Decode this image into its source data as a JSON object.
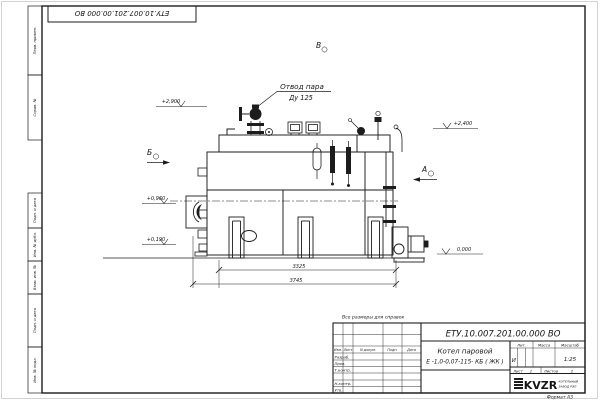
{
  "corner_stamp": {
    "doc_number": "ЕТУ.10.007.201.00.000  ВО"
  },
  "margin_labels": {
    "perv_primen": "Перв. примен.",
    "sprav_no": "Справ. №",
    "podp_data_1": "Подп. и дата",
    "inv_dubl": "Инв. № дубл.",
    "vzam_inv": "Взам. инв. №",
    "podp_data_2": "Подп. и дата",
    "inv_podl": "Инв. № подл."
  },
  "drawing": {
    "callout": {
      "line1": "Отвод пара",
      "line2": "Ду 125"
    },
    "views": {
      "top": "В",
      "left": "Б",
      "right": "А"
    },
    "elevations": {
      "e1": "+2,900",
      "e2": "+2,400",
      "e3": "+0,960",
      "e4": "+0,190",
      "e5": "0,000"
    },
    "dimensions": {
      "d1": "3325",
      "d2": "3745"
    }
  },
  "title_block": {
    "note": "Все размеры для справок",
    "doc_number": "ЕТУ.10.007.201.00.000  ВО",
    "product_name_line1": "Котел паровой",
    "product_name_line2": "Е -1,0-0,07-115- КБ ( ЖК )",
    "header_izm": "Изм.",
    "header_list": "Лист",
    "header_ndoc": "N докум.",
    "header_podp": "Подп.",
    "header_data": "Дата",
    "row_razrab": "Разраб.",
    "row_prov": "Пров.",
    "row_tkontr": "Т.контр.",
    "row_nkontr": "Н.контр.",
    "row_utv": "Утв.",
    "lit_header": "Лит.",
    "massa_header": "Масса",
    "masshtab_header": "Масштаб",
    "lit_value": "И",
    "scale_value": "1:25",
    "sheet_label": "Лист",
    "sheet_value": "1",
    "sheets_label": "Листов",
    "sheets_value": "2",
    "logo_text": "KVZR",
    "logo_sub1": "КОТЕЛЬНЫЙ",
    "logo_sub2": "ЗАВОД РЭП",
    "format_label": "Формат А3"
  }
}
